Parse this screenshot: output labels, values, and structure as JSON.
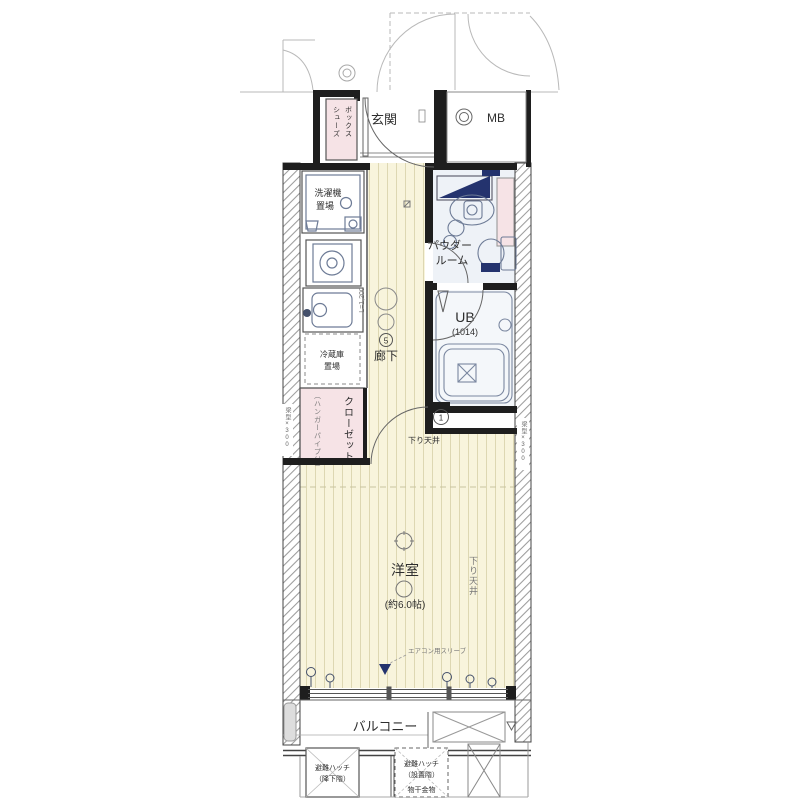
{
  "colors": {
    "navy": "#24336e",
    "floor": "#f8f4dc",
    "pink": "#f6e3e6",
    "powder_floor": "#eef2f7",
    "bath_floor": "#f4f7fa"
  },
  "labels": {
    "entrance": "玄関",
    "shoe_box_col1": "シューズ",
    "shoe_box_col2": "ボックス",
    "meter_box": "MB",
    "washer_line1": "洗濯機",
    "washer_line2": "置場",
    "fridge_line1": "冷蔵庫",
    "fridge_line2": "置場",
    "closet": "クローゼット",
    "closet_note": "（ハンガーパイプ付）",
    "corridor": "廊下",
    "corridor_dim": "L=1,200",
    "corridor_mark": "5",
    "powder_line1": "パウダー",
    "powder_line2": "ルーム",
    "bath": "UB",
    "bath_size": "(1014)",
    "room": "洋室",
    "room_size": "(約6.0帖)",
    "lowered_ceiling_door": "下り天井",
    "lowered_ceiling_side": "下り天井",
    "wall_note_left": "梁型×300",
    "wall_note_right": "梁型×300",
    "door_mark": "1",
    "ac_note": "エアコン用スリーブ",
    "balcony": "バルコニー",
    "hatch_left_line1": "避難ハッチ",
    "hatch_left_line2": "（降下階）",
    "hatch_right_line1": "避難ハッチ",
    "hatch_right_line2": "（設置階）",
    "hatch_right_line3": "物干金物"
  }
}
